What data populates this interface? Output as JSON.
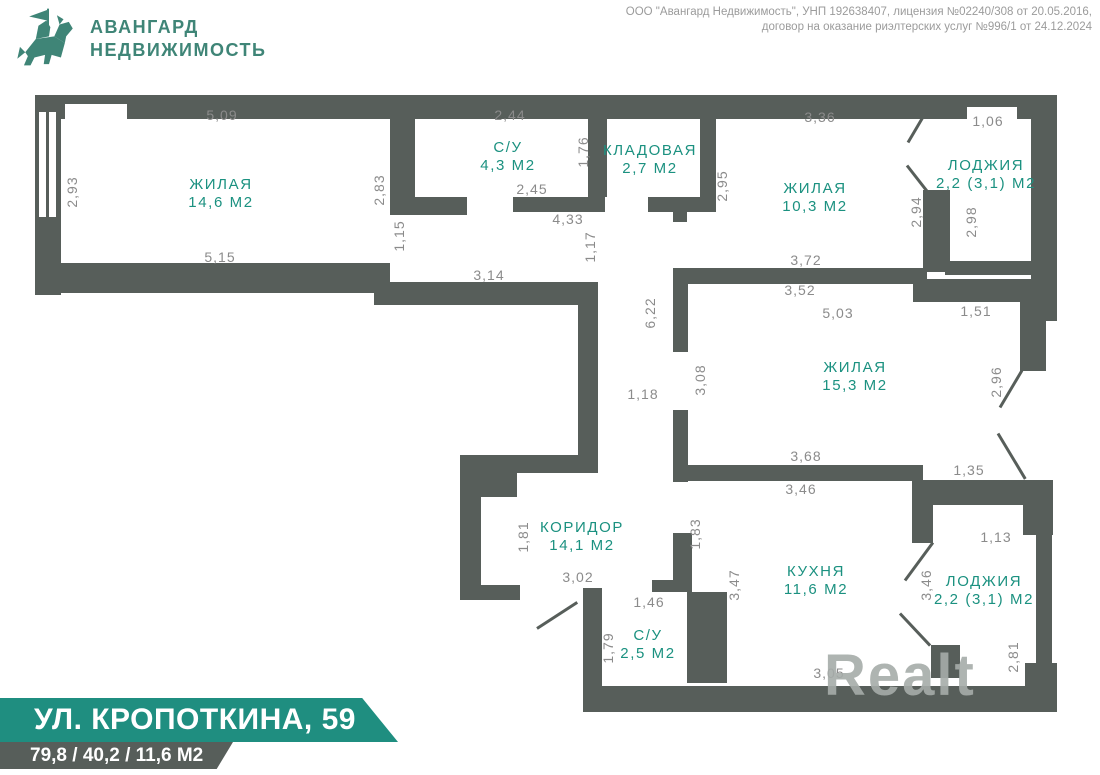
{
  "header": {
    "logo_line1": "АВАНГАРД",
    "logo_line2": "НЕДВИЖИМОСТЬ",
    "info_line1": "ООО \"Авангард Недвижимость\", УНП 192638407, лицензия №02240/308 от 20.05.2016,",
    "info_line2": "договор на оказание риэлтерских услуг №996/1 от 24.12.2024"
  },
  "footer": {
    "address": "УЛ. КРОПОТКИНА, 59",
    "areas": "79,8 / 40,2 / 11,6 М2"
  },
  "watermark": "Realt",
  "colors": {
    "wall_gray": "#575E5A",
    "room_label_teal": "#1B9180",
    "banner_teal": "#1F8E80",
    "logo_teal": "#3F8577",
    "dimension_text": "#8B8B8B",
    "info_text": "#9B9B9B",
    "watermark_gray": "#A6ACA9"
  },
  "rooms": [
    {
      "name": "ЖИЛАЯ",
      "area": "14,6 М2"
    },
    {
      "name": "С/У",
      "area": "4,3 М2"
    },
    {
      "name": "КЛАДОВАЯ",
      "area": "2,7 М2"
    },
    {
      "name": "ЖИЛАЯ",
      "area": "10,3 М2"
    },
    {
      "name": "ЛОДЖИЯ",
      "area": "2,2 (3,1) М2"
    },
    {
      "name": "ЖИЛАЯ",
      "area": "15,3 М2"
    },
    {
      "name": "КОРИДОР",
      "area": "14,1 М2"
    },
    {
      "name": "КУХНЯ",
      "area": "11,6 М2"
    },
    {
      "name": "С/У",
      "area": "2,5 М2"
    },
    {
      "name": "ЛОДЖИЯ",
      "area": "2,2 (3,1) М2"
    }
  ],
  "dims": [
    "5,09",
    "2,93",
    "2,83",
    "1,15",
    "5,15",
    "2,44",
    "1,76",
    "2,45",
    "4,33",
    "1,17",
    "3,14",
    "2,95",
    "3,36",
    "1,06",
    "2,94",
    "2,98",
    "3,72",
    "3,52",
    "5,03",
    "1,51",
    "6,22",
    "3,08",
    "1,18",
    "2,96",
    "3,68",
    "3,46",
    "1,35",
    "1,13",
    "3,46",
    "2,81",
    "1,81",
    "3,02",
    "1,83",
    "3,47",
    "1,46",
    "1,79",
    "3,05"
  ]
}
